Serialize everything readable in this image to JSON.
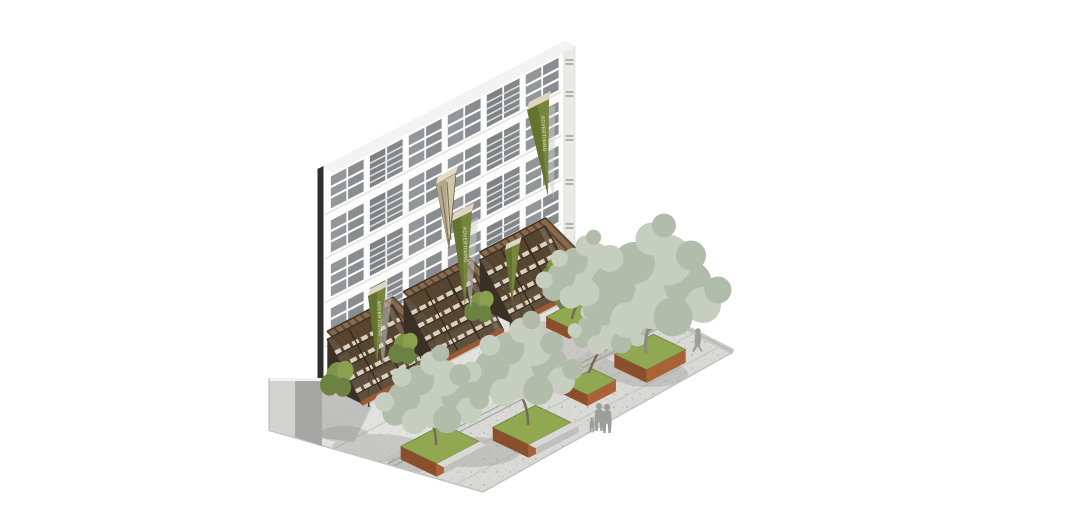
{
  "image": {
    "type": "architectural-axonometric-rendering",
    "description": "SketchUp-style axonometric rendering: white mid-rise residential facade section with hanging green pennant banners, timber-canopy ground-floor retail vitrines with shelving, and a paved plaza with corten tree planters, benches, sage-toned trees and pedestrian silhouettes",
    "background_color": "#ffffff"
  },
  "building": {
    "facade_color": "#fcfcfb",
    "window_pane_color": "#8f9290",
    "window_rows": 5,
    "window_bays": 6,
    "section_cut_edge_color": "#2e2e2c",
    "side_slab_color": "#e9e9e7"
  },
  "banners": {
    "label": "ADVERTISING",
    "green_count": 4,
    "tan_count": 1,
    "color": "#76863c",
    "shade_color": "#64732f",
    "fold_color": "#ddd6c0",
    "text_color": "#edf0e2"
  },
  "storefronts": {
    "count": 3,
    "canopy_color": "#8a6a4c",
    "canopy_slat_color": "#5d4936",
    "glass_interior_color": "#54432f",
    "shelf_item_color": "#d9d1bd",
    "base_color": "#9b5a31"
  },
  "plaza": {
    "sidewalk_color": "#ececea",
    "pavement_color": "#e2e2df",
    "road_band_color": "#d9d9d6",
    "joint_line_color": "#c6c6c4",
    "rail_line_color": "#a9a9a7",
    "shadow_color": "#8e948c"
  },
  "planters": {
    "count": 5,
    "grass_color": "#8fa851",
    "corten_dark": "#8c4f2b",
    "corten_light": "#a86236",
    "bench_color": "#d8d8d6"
  },
  "trees": {
    "count": 5,
    "foliage_light": "#c6cec0",
    "foliage_mid": "#b1bcaa",
    "trunk_color": "#7a6a55",
    "large_trunk_color": "#8d8a80"
  },
  "shrubs": {
    "count": 6,
    "color_light": "#8ba04f",
    "color_dark": "#6d8140"
  },
  "pedestrians": {
    "count": 4,
    "color": "#99a099"
  }
}
